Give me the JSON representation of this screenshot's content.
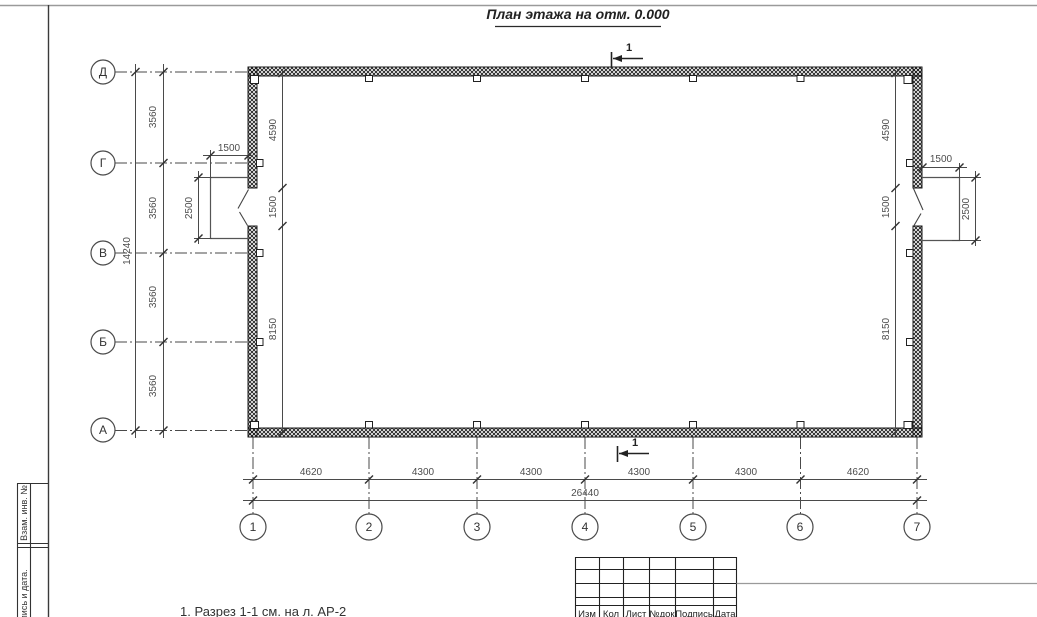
{
  "title": "План этажа на отм. 0.000",
  "note": "1. Разрез 1-1 см. на л. АР-2",
  "section": {
    "top": "1",
    "bottom": "1"
  },
  "axes": {
    "rows": [
      "Д",
      "Г",
      "В",
      "Б",
      "А"
    ],
    "cols": [
      "1",
      "2",
      "3",
      "4",
      "5",
      "6",
      "7"
    ]
  },
  "dims": {
    "row_segments": [
      "3560",
      "3560",
      "3560",
      "3560"
    ],
    "row_total": "14240",
    "col_segments": [
      "4620",
      "4300",
      "4300",
      "4300",
      "4300",
      "4620"
    ],
    "col_total": "26440",
    "wall_left": [
      "4590",
      "1500",
      "8150"
    ],
    "wall_right": [
      "4590",
      "1500",
      "8150"
    ],
    "porch_left": {
      "w": "1500",
      "d": "2500"
    },
    "porch_right": {
      "w": "1500",
      "d": "2500"
    }
  },
  "stamp": {
    "cols": [
      "Изм",
      "Кол",
      "Лист",
      "№док",
      "Подпись",
      "Дата"
    ]
  },
  "sidebar": {
    "labels": [
      "Взам. инв. №",
      "Подпись и дата."
    ]
  },
  "colors": {
    "line": "#3f3f3f",
    "wall": "#1a1a1a",
    "frame_gray": "#9a9a9a"
  }
}
